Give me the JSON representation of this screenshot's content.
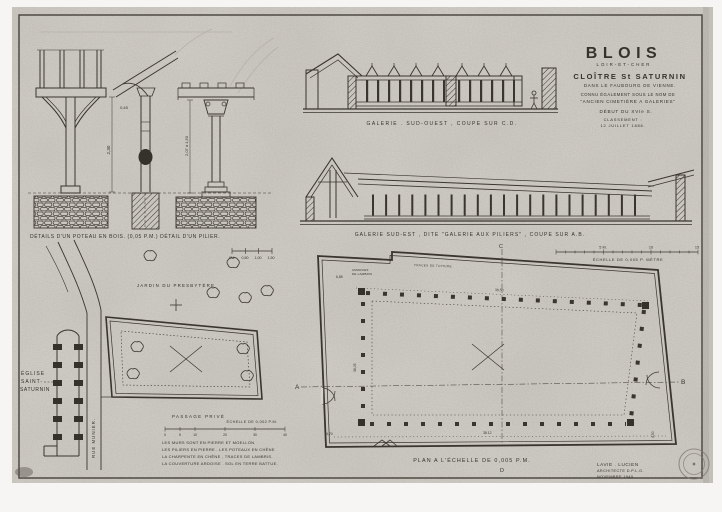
{
  "colors": {
    "paper": "#d6d3cc",
    "ink": "#3a362e"
  },
  "title_block": {
    "city": "BLOIS",
    "department": "LOIR-ET-CHER",
    "monument": "CLOÎTRE St SATURNIN",
    "location": "DANS LE FAUBOURG DE VIENNE.",
    "aka_line1": "CONNU ÉGALEMENT SOUS LE NOM DE",
    "aka_line2": "\"ANCIEN CIMETIÈRE A GALERIES\"",
    "period": "DÉBUT DU XVIe S.",
    "classement_line1": "CLASSEMENT :",
    "classement_line2": "12 JUILLET 1886."
  },
  "views": {
    "details": {
      "caption": "DÉTAILS D'UN POTEAU EN BOIS. (0,05 P.M.)   DÉTAIL D'UN PILIER.",
      "scale_ticks": [
        "0M.",
        "0,50",
        "1,00",
        "1,50"
      ],
      "dim_post_height": "2,30",
      "dim_brace": "0,45",
      "dim_pillar": "2,07 à 1,50"
    },
    "galerie_sud_ouest": {
      "caption": "GALERIE . SUD-OUEST , COUPE SUR C.D."
    },
    "galerie_sud_est": {
      "caption": "GALERIE SUD-EST , DITE \"GALERIE AUX PILIERS\" , COUPE SUR A.B.",
      "scale_ticks": [
        "5 M.",
        "10",
        "15"
      ],
      "scale_caption": "ÉCHELLE DE 0,005 P. MÈTRE"
    },
    "site_plan": {
      "jardin_label": "JARDIN DU PRESBYTÈRE",
      "eglise_line1": "ÉGLISE",
      "eglise_line2": "SAINT-",
      "eglise_line3": "SATURNIN",
      "rue_label": "RUE MUNIER.",
      "passage_label": "PASSAGE PRIVÉ",
      "scale_caption": "ÉCHELLE DE 0,002 P.M.",
      "scale_ticks": [
        "0",
        "5",
        "10",
        "20",
        "30",
        "40"
      ]
    },
    "grand_plan": {
      "caption": "PLAN A L'ÉCHELLE DE 0,005 P.M.",
      "marker_a": "A",
      "marker_b": "B",
      "marker_c": "C",
      "marker_d": "D",
      "annotation_wall": "TRACES DE TOITURE",
      "annotation_gallery_1": "AMORCES",
      "annotation_gallery_2": "DE LAMBRIS",
      "dim_gallery_width": "6,85",
      "dim_top": "38,50",
      "dim_west": "36,05",
      "dim_bottom_left": "4,70",
      "dim_bottom": "38.12",
      "dim_bottom_right": "4,50"
    }
  },
  "notes_lines": [
    "LES MURS SONT EN PIERRE ET MOELLON.",
    "LES PILIERS EN PIERRE . LES POTEAUX EN CHÊNE",
    "LA CHARPENTE EN CHÊNE , TRACES DE LAMBRIS.",
    "LA COUVERTURE ARDOISE . SOL EN TERRE BATTUE."
  ],
  "signature_lines": [
    "LAVIE . LUCIEN",
    "ARCHITECTE D.P.L.G.",
    "NOVEMBRE 1945"
  ]
}
